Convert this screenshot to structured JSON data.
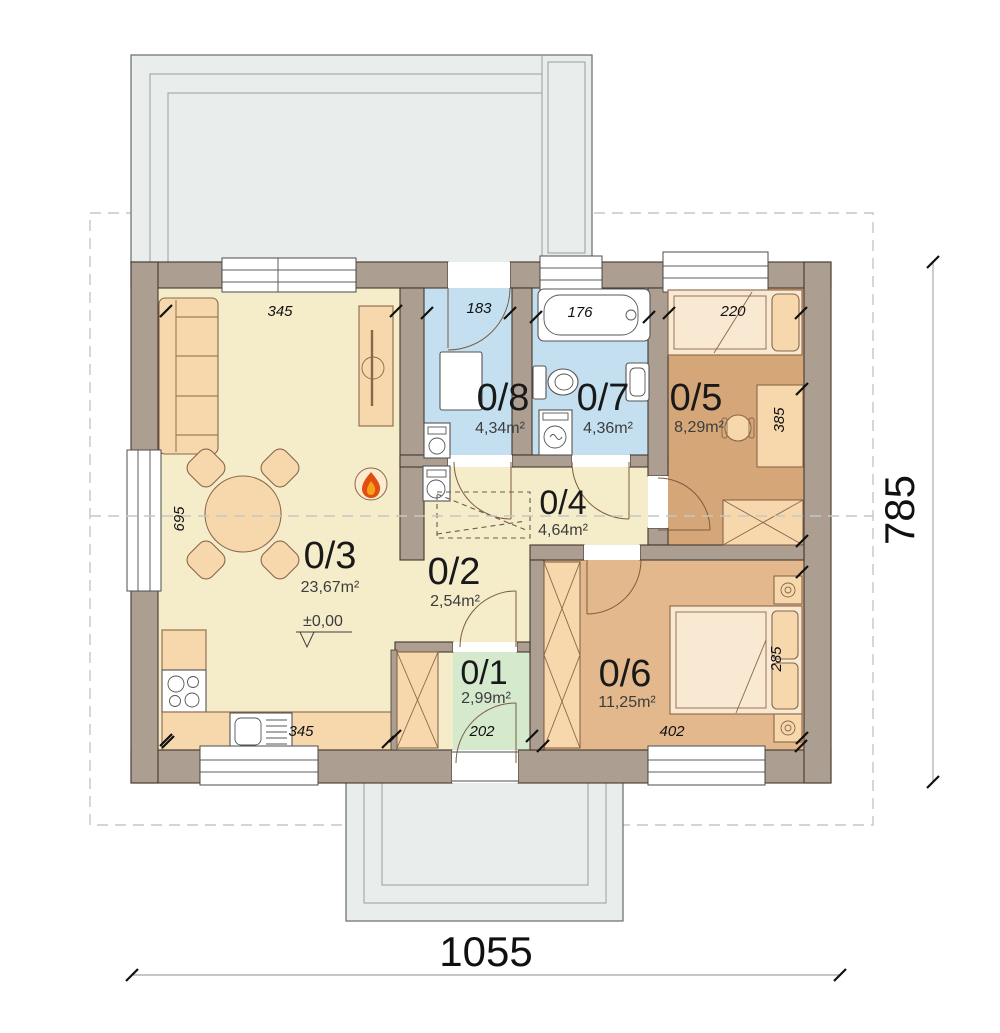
{
  "rooms": [
    {
      "number": "0/1",
      "area": "2,99m²"
    },
    {
      "number": "0/2",
      "area": "2,54m²"
    },
    {
      "number": "0/3",
      "area": "23,67m²"
    },
    {
      "number": "0/4",
      "area": "4,64m²"
    },
    {
      "number": "0/5",
      "area": "8,29m²"
    },
    {
      "number": "0/6",
      "area": "11,25m²"
    },
    {
      "number": "0/7",
      "area": "4,36m²"
    },
    {
      "number": "0/8",
      "area": "4,34m²"
    }
  ],
  "dimensions": {
    "overall_width": "1055",
    "overall_height": "785",
    "living_width": "345",
    "living_depth": "695",
    "kitchen_run": "345",
    "room8_width": "183",
    "bathtub_length": "176",
    "bed5_length": "220",
    "room5_depth": "385",
    "hall_width": "202",
    "room6_width": "402",
    "room6_depth": "285",
    "level_mark": "±0,00"
  },
  "colors": {
    "wall": "#ac9e90",
    "outline": "#42382e",
    "floor-main": "#f5ecca",
    "floor-wet": "#c4e0f0",
    "floor-office": "#d5a678",
    "floor-bedroom": "#e3b88d",
    "floor-entry": "#d5e9cd",
    "furniture": "#f6d8ac",
    "furniture-light": "#f9e8d2",
    "terrace": "#e9edec",
    "flame-outer": "#e04f10",
    "flame-inner": "#f7a219"
  }
}
